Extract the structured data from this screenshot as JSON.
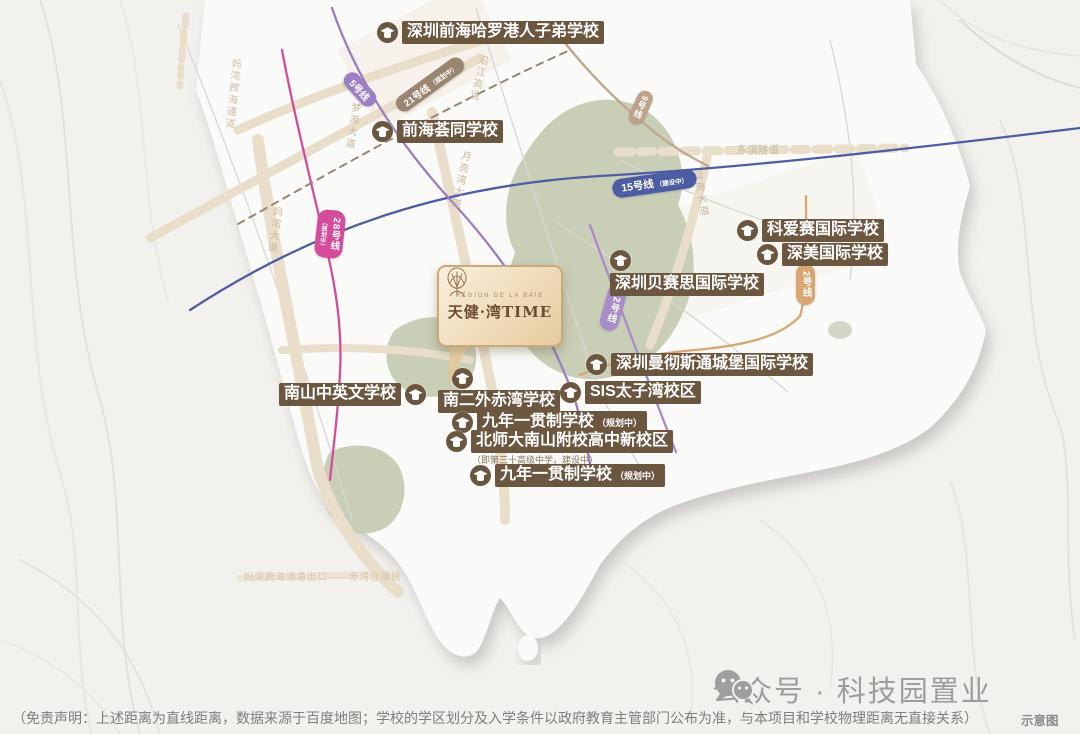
{
  "project": {
    "brand_en": "RÉGION DE LA BAIE",
    "brand_cn": "天健·湾TIME"
  },
  "schools": [
    {
      "name": "深圳前海哈罗港人子弟学校"
    },
    {
      "name": "前海荟同学校"
    },
    {
      "name": "科爱赛国际学校"
    },
    {
      "name": "深美国际学校"
    },
    {
      "name": "深圳贝赛思国际学校"
    },
    {
      "name": "深圳曼彻斯通城堡国际学校"
    },
    {
      "name": "SIS太子湾校区"
    },
    {
      "name": "南山中英文学校"
    },
    {
      "name": "南二外赤湾学校"
    },
    {
      "name": "九年一贯制学校",
      "suffix": "（规划中）"
    },
    {
      "name": "北师大南山附校高中新校区",
      "note": "（即第三十高级中学，建设中）"
    },
    {
      "name": "九年一贯制学校",
      "suffix": "（规划中）"
    }
  ],
  "metro_lines": [
    {
      "label": "5号线",
      "color": "#9d80c3"
    },
    {
      "label": "21号线",
      "suffix": "（规划中）",
      "color": "#9a8571"
    },
    {
      "label": "15号线",
      "suffix": "（建设中）",
      "color": "#4c5da3"
    },
    {
      "label": "28号线",
      "suffix": "（规划中）",
      "color": "#d64c9c"
    },
    {
      "label": "9号线",
      "color": "#bda189"
    },
    {
      "label": "12号线",
      "color": "#a78cc9"
    },
    {
      "label": "2号线",
      "color": "#d8a672"
    }
  ],
  "roads": [
    {
      "label": "妈湾跨海通道"
    },
    {
      "label": "妈湾大道"
    },
    {
      "label": "梦海大道"
    },
    {
      "label": "沿江高速"
    },
    {
      "label": "月亮湾大道"
    },
    {
      "label": "东滨隧道"
    },
    {
      "label": "南海大道"
    },
    {
      "label": "妈湾跨海通道出口——赤湾连接线"
    }
  ],
  "footer": {
    "wechat_label": "公众号 · 科技园置业",
    "disclaimer": "（免责声明：上述距离为直线距离，数据来源于百度地图；学校的学区划分及入学条件以政府教育主管部门公布为准，与本项目和学校物理距离无直接关系）",
    "schematic_note": "示意图"
  },
  "colors": {
    "school_label_bg": "#6b5640",
    "map_background": "#f2f1ee",
    "park_green": "#c9ceb7",
    "road_tan": "#e9dec9"
  }
}
